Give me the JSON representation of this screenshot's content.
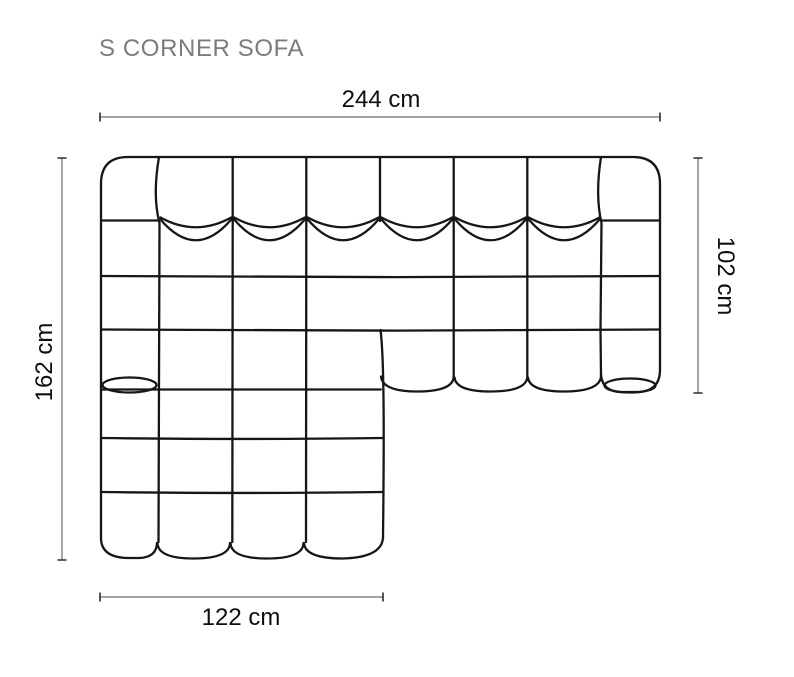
{
  "title": "S CORNER SOFA",
  "dimensions": {
    "top": "244 cm",
    "right": "102 cm",
    "left": "162 cm",
    "bottom": "122 cm"
  },
  "figure": {
    "kind": "top-view line drawing",
    "subject": "L-shaped modular corner sofa with tufted cushions",
    "back_cushions": 6,
    "armrest_segments_per_side": 4,
    "chaise_front_cushions": 4,
    "right_section_front_cushions": 3
  },
  "colors": {
    "sofa_outline": "#161616",
    "dimension_line": "#6a6a6a",
    "dimension_tick": "#2c2c2c",
    "dimension_text": "#0f0f0f",
    "title_text": "#7c7c7c",
    "background": "#ffffff"
  }
}
